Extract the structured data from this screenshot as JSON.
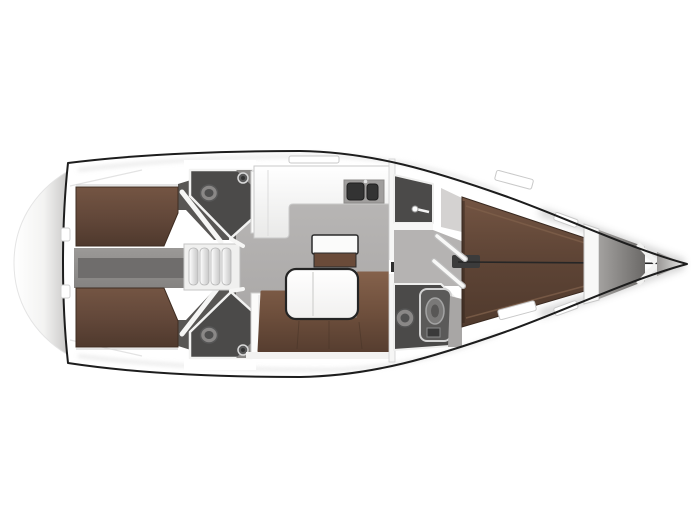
{
  "plan": {
    "type": "yacht-interior-floor-plan",
    "orientation": "bow-right",
    "regions": [
      "transom-swim-platform",
      "hull",
      "aft-cabin-port-berth",
      "aft-cabin-starboard-berth",
      "engine-compartment",
      "companionway-steps",
      "aft-head-port",
      "aft-head-starboard",
      "galley",
      "galley-sinks",
      "sideboard",
      "salon-sofa",
      "salon-table",
      "mast-post",
      "wet-room",
      "forward-corridor",
      "forward-head-shower",
      "owner-cabin-berth",
      "anchor-locker",
      "bow-tip"
    ]
  },
  "colors": {
    "background": "#ffffff",
    "deck_white": "#ffffff",
    "hull_outline": "#1d1d1d",
    "wall_white": "#f4f4f3",
    "trim_gray": "#c9c9c9",
    "shadow_gray": "#9a9a9a",
    "floor_gray": "#aeacab",
    "corridor_gray": "#b5b3b2",
    "cabin_floor_dark": "#585654",
    "head_room_dark": "#4b4a49",
    "fixture_light": "#8a8887",
    "fixture_dark": "#4f4f4f",
    "engine_dark": "#6f6d6c",
    "berth_brown": "#5e4334",
    "sofa_brown": "#6d4e3c",
    "cabinet_brown": "#6a4b39",
    "counter_white": "#f7f7f6",
    "sink_panel": "#a09e9d",
    "sink_dark": "#333333",
    "table_white": "#fcfcfb",
    "table_outline": "#242424",
    "anchor_gray": "#8a8886"
  }
}
